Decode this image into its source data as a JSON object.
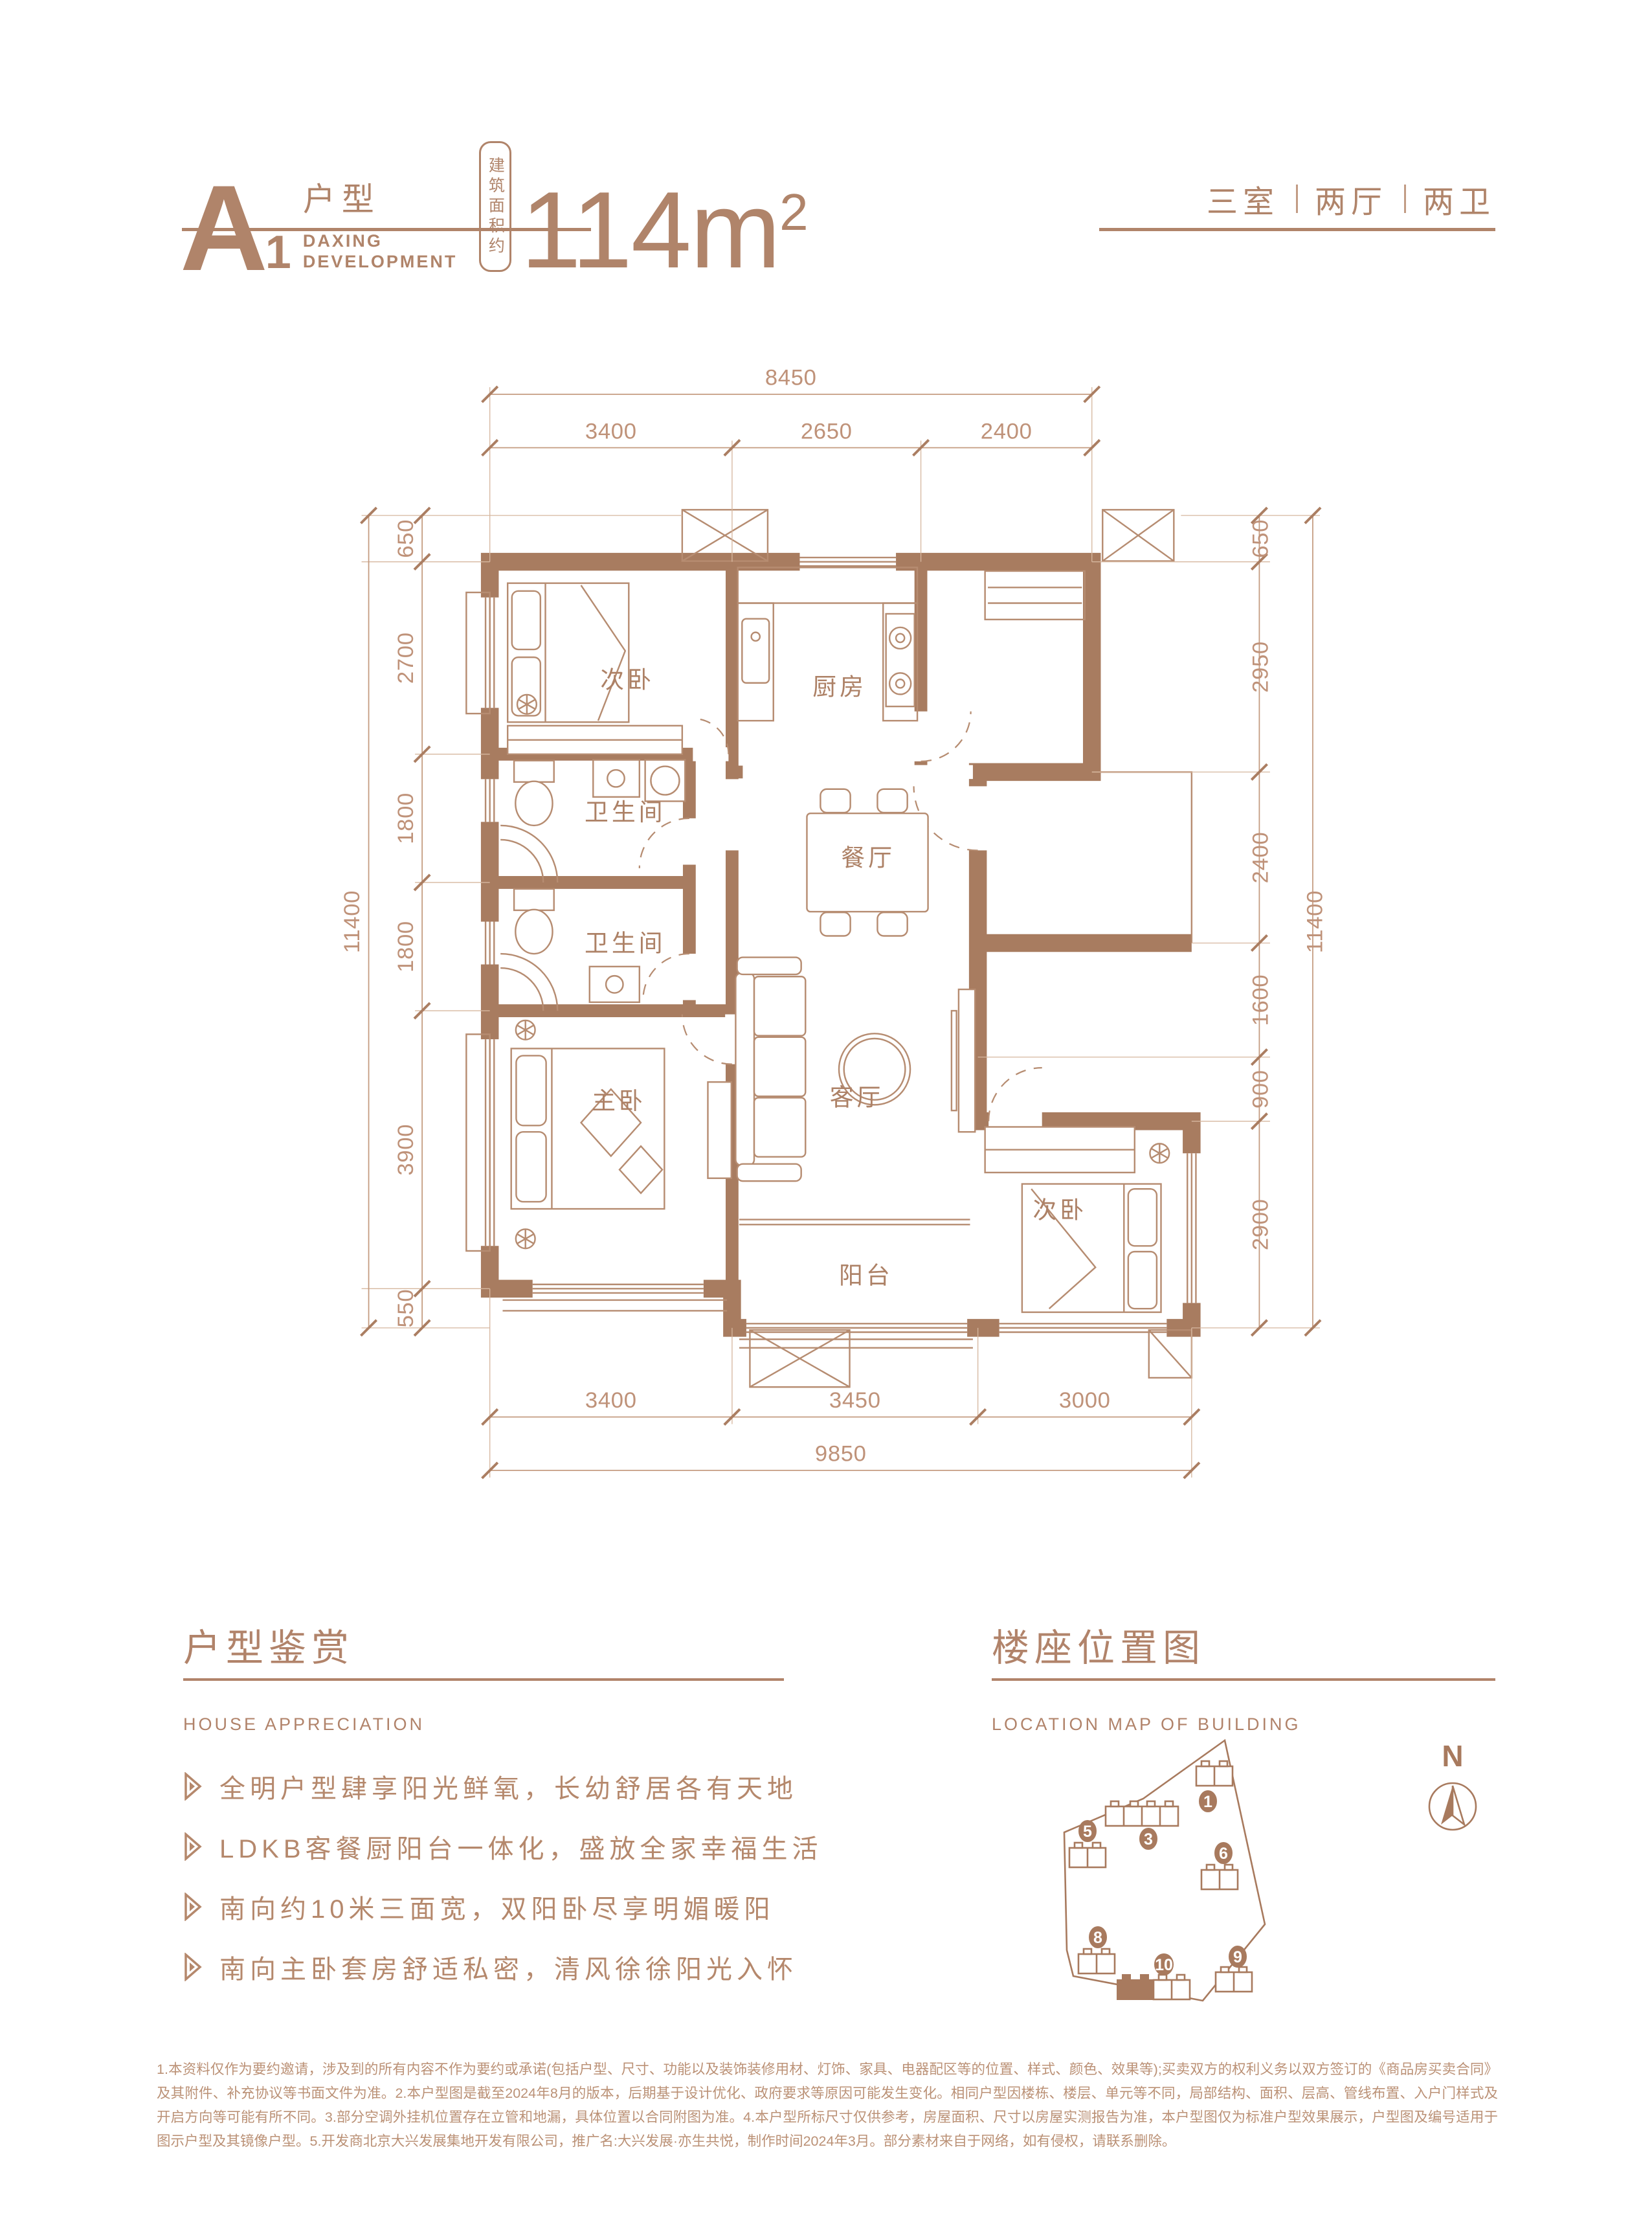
{
  "header": {
    "unit_letter": "A",
    "unit_number": "1",
    "unit_type_label": "户型",
    "brand_line1": "DAXING",
    "brand_line2": "DEVELOPMENT",
    "area_prefix": "建筑面积约",
    "area_value": "114",
    "area_unit": "m",
    "area_exponent": "2",
    "layout_tags": [
      "三室",
      "两厅",
      "两卫"
    ]
  },
  "floor_plan": {
    "rooms": {
      "bedroom_top": "次卧",
      "kitchen": "厨房",
      "bath_1": "卫生间",
      "bath_2": "卫生间",
      "dining": "餐厅",
      "living": "客厅",
      "master": "主卧",
      "balcony": "阳台",
      "bedroom_right": "次卧"
    },
    "dimensions": {
      "top": {
        "overall": "8450",
        "segments": [
          "3400",
          "2650",
          "2400"
        ]
      },
      "bottom": {
        "overall": "9850",
        "segments": [
          "3400",
          "3450",
          "3000"
        ]
      },
      "left": {
        "overall": "11400",
        "segments": [
          "650",
          "2700",
          "1800",
          "1800",
          "3900",
          "550"
        ]
      },
      "right": {
        "overall": "11400",
        "segments": [
          "650",
          "2950",
          "2400",
          "1600",
          "900",
          "2900"
        ]
      }
    }
  },
  "appreciation": {
    "title": "户型鉴赏",
    "subtitle": "HOUSE  APPRECIATION",
    "bullets": [
      "全明户型肆享阳光鲜氧，长幼舒居各有天地",
      "LDKB客餐厨阳台一体化，盛放全家幸福生活",
      "南向约10米三面宽，双阳卧尽享明媚暖阳",
      "南向主卧套房舒适私密，清风徐徐阳光入怀"
    ]
  },
  "location": {
    "title": "楼座位置图",
    "subtitle": "LOCATION MAP OF BUILDING",
    "compass": "N",
    "buildings": [
      "1",
      "3",
      "5",
      "6",
      "8",
      "9",
      "10"
    ]
  },
  "footer": {
    "disclaimer": "1.本资料仅作为要约邀请，涉及到的所有内容不作为要约或承诺(包括户型、尺寸、功能以及装饰装修用材、灯饰、家具、电器配区等的位置、样式、颜色、效果等);买卖双方的权利义务以双方签订的《商品房买卖合同》及其附件、补充协议等书面文件为准。2.本户型图是截至2024年8月的版本，后期基于设计优化、政府要求等原因可能发生变化。相同户型因楼栋、楼层、单元等不同，局部结构、面积、层高、管线布置、入户门样式及开启方向等可能有所不同。3.部分空调外挂机位置存在立管和地漏，具体位置以合同附图为准。4.本户型所标尺寸仅供参考，房屋面积、尺寸以房屋实测报告为准，本户型图仅为标准户型效果展示，户型图及编号适用于图示户型及其镜像户型。5.开发商北京大兴发展集地开发有限公司，推广名:大兴发展·亦生共悦，制作时间2024年3月。部分素材来自于网络，如有侵权，请联系删除。"
  }
}
